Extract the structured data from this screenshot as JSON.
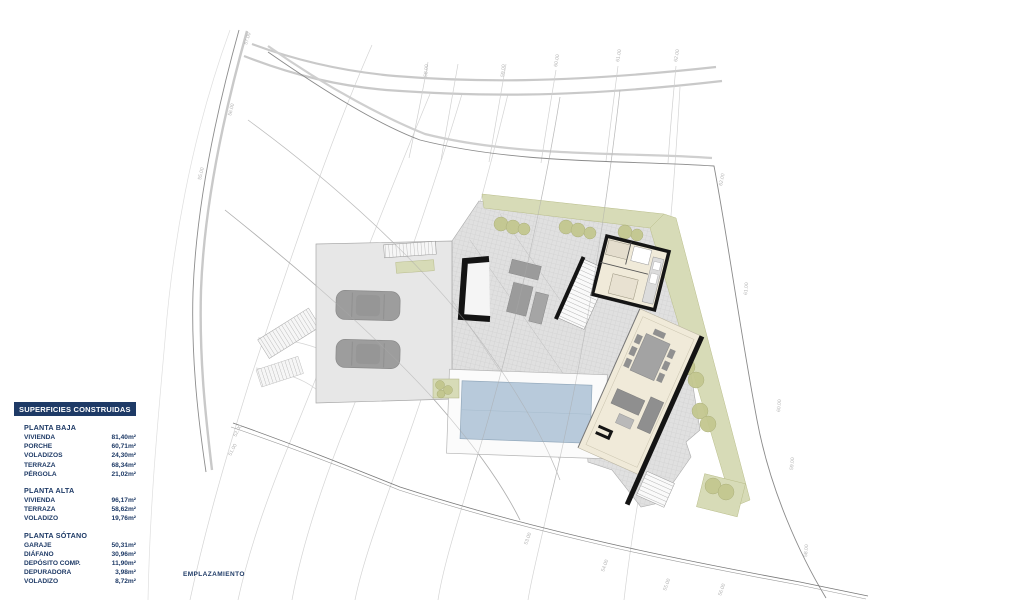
{
  "plan_caption": "EMPLAZAMIENTO",
  "legend": {
    "header": "SUPERFICIES CONSTRUIDAS",
    "sections": [
      {
        "title": "PLANTA BAJA",
        "rows": [
          {
            "label": "VIVIENDA",
            "value": "81,40m²"
          },
          {
            "label": "PORCHE",
            "value": "60,71m²"
          },
          {
            "label": "VOLADIZOS",
            "value": "24,30m²"
          },
          {
            "label": "TERRAZA",
            "value": "68,34m²"
          },
          {
            "label": "PÉRGOLA",
            "value": "21,02m²"
          }
        ]
      },
      {
        "title": "PLANTA ALTA",
        "rows": [
          {
            "label": "VIVIENDA",
            "value": "96,17m²"
          },
          {
            "label": "TERRAZA",
            "value": "58,62m²"
          },
          {
            "label": "VOLADIZO",
            "value": "19,76m²"
          }
        ]
      },
      {
        "title": "PLANTA SÓTANO",
        "rows": [
          {
            "label": "GARAJE",
            "value": "50,31m²"
          },
          {
            "label": "DIÁFANO",
            "value": "30,96m²"
          },
          {
            "label": "DEPÓSITO COMP.",
            "value": "11,90m²"
          },
          {
            "label": "DEPURADORA",
            "value": "3,98m²"
          },
          {
            "label": "VOLADIZO",
            "value": "8,72m²"
          }
        ]
      }
    ]
  },
  "site_plan": {
    "contour_labels": [
      {
        "text": "57.00",
        "x": 247,
        "y": 45,
        "rot": -73
      },
      {
        "text": "56.00",
        "x": 231,
        "y": 116,
        "rot": -75
      },
      {
        "text": "55.00",
        "x": 201,
        "y": 180,
        "rot": -77
      },
      {
        "text": "52.00",
        "x": 236,
        "y": 437,
        "rot": -62
      },
      {
        "text": "51.00",
        "x": 231,
        "y": 456,
        "rot": -62
      },
      {
        "text": "58.00",
        "x": 427,
        "y": 77,
        "rot": -85
      },
      {
        "text": "59.00",
        "x": 504,
        "y": 77,
        "rot": -85
      },
      {
        "text": "60.00",
        "x": 557,
        "y": 67,
        "rot": -80
      },
      {
        "text": "61.00",
        "x": 619,
        "y": 62,
        "rot": -80
      },
      {
        "text": "62.00",
        "x": 677,
        "y": 62,
        "rot": -80
      },
      {
        "text": "62.00",
        "x": 722,
        "y": 186,
        "rot": -78
      },
      {
        "text": "61.00",
        "x": 747,
        "y": 295,
        "rot": -85
      },
      {
        "text": "60.00",
        "x": 780,
        "y": 412,
        "rot": -85
      },
      {
        "text": "59.00",
        "x": 793,
        "y": 470,
        "rot": -85
      },
      {
        "text": "58.00",
        "x": 807,
        "y": 557,
        "rot": -85
      },
      {
        "text": "53.00",
        "x": 527,
        "y": 545,
        "rot": -70
      },
      {
        "text": "54.00",
        "x": 604,
        "y": 572,
        "rot": -70
      },
      {
        "text": "55.00",
        "x": 666,
        "y": 591,
        "rot": -70
      },
      {
        "text": "56.00",
        "x": 721,
        "y": 596,
        "rot": -70
      }
    ],
    "colors": {
      "navy": "#1e3a66",
      "terrace": "#e0e0e0",
      "garden": "#d7dbb7",
      "tree": "#c3c78f",
      "pool": "#b8cadb",
      "floor": "#f0ead9",
      "wall": "#141414"
    }
  }
}
